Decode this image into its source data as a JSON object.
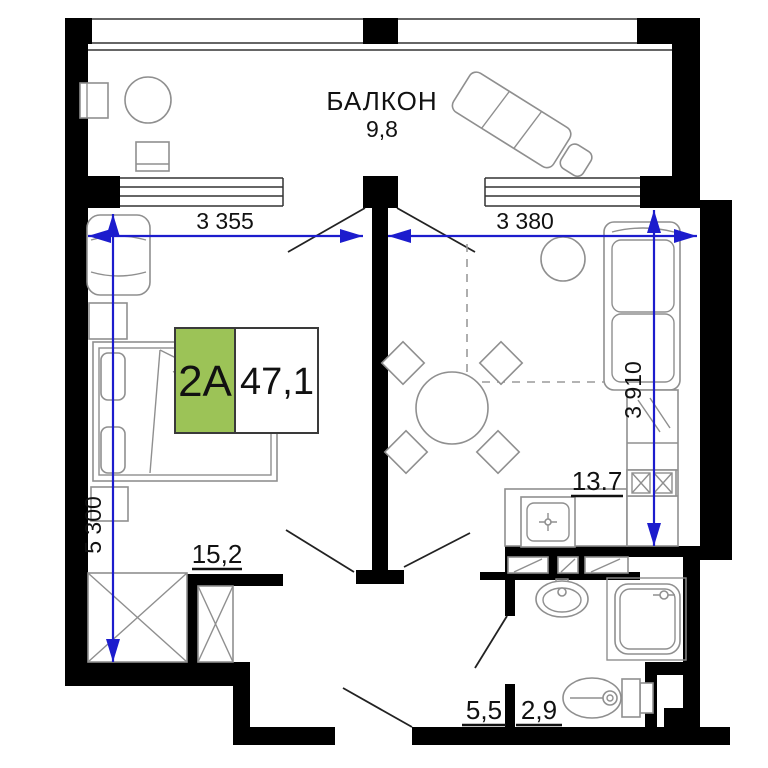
{
  "plan": {
    "badge": {
      "unit": "2A",
      "total_area": "47,1"
    },
    "balcony": {
      "name": "БАЛКОН",
      "area": "9,8"
    },
    "rooms": {
      "bedroom_area": "15,2",
      "kitchen_area": "13.7",
      "hall_area": "5,5",
      "bathroom_area": "2,9"
    },
    "dimensions": {
      "bedroom_width": "3 355",
      "living_width": "3 380",
      "left_height": "5 300",
      "right_height": "3 910"
    },
    "colors": {
      "dimension_blue": "#1c1ccd",
      "badge_green": "#9cc357",
      "wall_black": "#000000"
    }
  }
}
